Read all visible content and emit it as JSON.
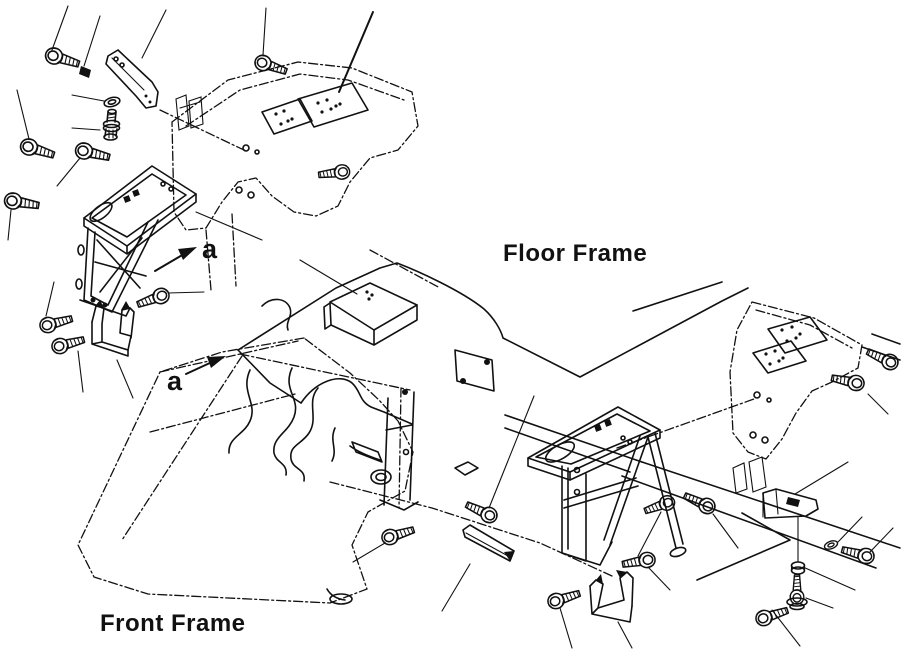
{
  "diagram": {
    "type": "exploded-parts-line-drawing",
    "labels": {
      "floor_frame": "Floor Frame",
      "front_frame": "Front Frame",
      "section_a_upper": "a",
      "section_a_lower": "a"
    },
    "colors": {
      "background": "#ffffff",
      "line": "#111111"
    }
  }
}
